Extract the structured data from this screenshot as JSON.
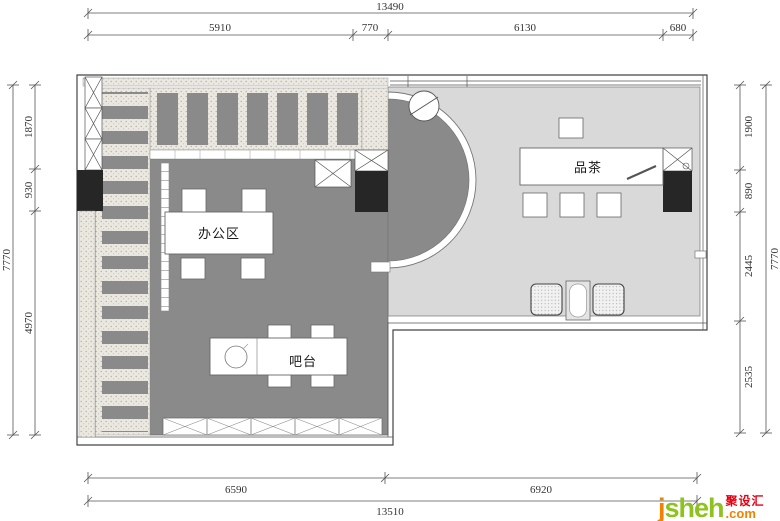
{
  "plan": {
    "rooms": {
      "office": "办公区",
      "bar": "吧台",
      "tea": "品茶"
    }
  },
  "dims": {
    "top": {
      "overall": "13490",
      "seg1": "5910",
      "seg2": "770",
      "seg3": "6130",
      "seg4": "680"
    },
    "left": {
      "overall": "7770",
      "seg1": "1870",
      "seg2": "930",
      "seg3": "4970"
    },
    "right": {
      "overall": "7770",
      "seg1": "1900",
      "seg2": "890",
      "seg3": "2445",
      "seg4": "2535"
    },
    "bottom": {
      "overall": "13510",
      "seg1": "6590",
      "seg2": "6920"
    }
  },
  "logo": {
    "j": "j",
    "sheh": "sheh",
    "cn": "聚设汇",
    "tld": ".com"
  },
  "colors": {
    "office_floor": "#8a8a8a",
    "tea_floor": "#d9d9d9",
    "column_black": "#262626",
    "logo_green": "#8dc21f",
    "logo_orange": "#f08300",
    "logo_red": "#e60012"
  }
}
